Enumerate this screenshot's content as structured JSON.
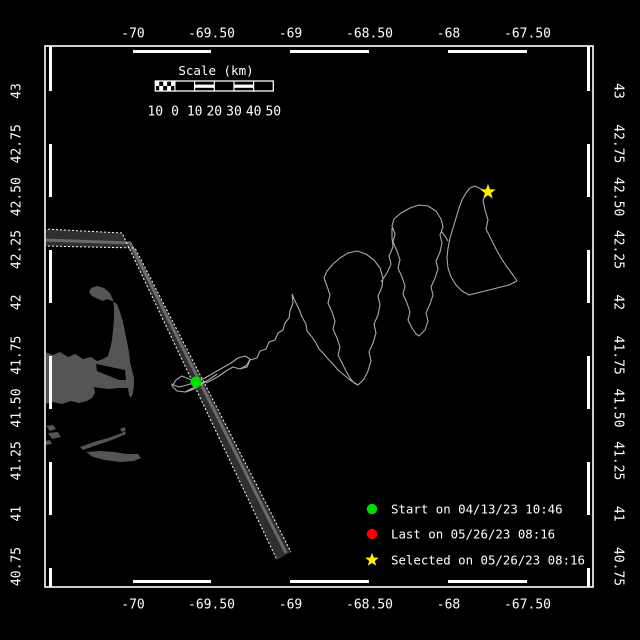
{
  "colors": {
    "background": "#000000",
    "frame": "#ffffff",
    "land": "#555555",
    "lane_band": "#2f2f2f",
    "lane_stripe": "#6a6a6a",
    "lane_edge": "#ffffff",
    "track": "#aaaaaa",
    "start_marker": "#00dd00",
    "last_marker": "#ff0000",
    "selected_marker": "#ffee00"
  },
  "axes": {
    "top": {
      "labels": [
        "-70",
        "-69.50",
        "-69",
        "-68.50",
        "-68",
        "-67.50"
      ],
      "ticks_px": [
        133,
        211.5,
        290.5,
        369.5,
        448.5,
        527.5
      ],
      "y_px": 33
    },
    "bottom": {
      "labels": [
        "-70",
        "-69.50",
        "-69",
        "-68.50",
        "-68",
        "-67.50"
      ],
      "ticks_px": [
        133,
        211.5,
        290.5,
        369.5,
        448.5,
        527.5
      ],
      "y_px": 604
    },
    "left": {
      "labels": [
        "43",
        "42.75",
        "42.50",
        "42.25",
        "42",
        "41.75",
        "41.50",
        "41.25",
        "41",
        "40.75"
      ],
      "ticks_px": [
        91,
        143.8,
        196.7,
        249.5,
        302.3,
        355.2,
        408,
        460.8,
        513.7,
        566.5
      ],
      "x_px": 16
    },
    "right": {
      "labels": [
        "43",
        "42.75",
        "42.50",
        "42.25",
        "42",
        "41.75",
        "41.50",
        "41.25",
        "41",
        "40.75"
      ],
      "ticks_px": [
        91,
        143.8,
        196.7,
        249.5,
        302.3,
        355.2,
        408,
        460.8,
        513.7,
        566.5
      ],
      "x_px": 619
    }
  },
  "scalebar": {
    "title": "Scale (km)",
    "labels": [
      "10",
      "0",
      "10",
      "20",
      "30",
      "40",
      "50"
    ],
    "label_px": [
      155.3,
      175,
      194.7,
      214.3,
      234,
      253.7,
      273.3
    ],
    "labels_y_px": 111,
    "title_x_px": 216,
    "title_y_px": 71
  },
  "legend": [
    {
      "marker": "circle",
      "color": "#00dd00",
      "icon": "start-dot-icon",
      "label": "Start on 04/13/23 10:46"
    },
    {
      "marker": "circle",
      "color": "#ff0000",
      "icon": "last-dot-icon",
      "label": "Last on 05/26/23 08:16"
    },
    {
      "marker": "star",
      "color": "#ffee00",
      "icon": "selected-star-icon",
      "label": "Selected on 05/26/23 08:16"
    }
  ],
  "legend_layout": {
    "marker_x": 372,
    "rows_y": [
      509,
      534,
      560
    ],
    "text_offset_x": 19
  },
  "map": {
    "coast_d": "M45,352 L53,355 L60,352 L68,357 L75,354 L83,359 L91,357 L97,361 L103,359 L108,356 L110,349 L112,340 L113,330 L114,319 L114,308 L113,300 L110,293 L104,288 L97,286 L91,288 L89,292 L92,296 L98,299 L103,301 L107,299 L112,301 L117,304 L120,312 L123,322 L125,332 L127,342 L129,352 L130,362 L132,370 L134,378 L134,386 L133,393 L131,398 L129,395 L128,388 L118,388 L109,389 L100,388 L94,387 L95,393 L92,398 L87,401 L79,403 L71,401 L62,404 L53,402 L45,404 Z",
    "bay_notch_d": "M96,364 L125,370 L126,380 L119,380 L97,371 Z",
    "islands_d": "M46,426 L53,425 L56,429 L50,431 Z M48,433 L58,432 L61,437 L52,439 Z M45,441 L50,440 L52,444 L46,445 Z M80,447 L94,442 L108,438 L122,433 L125,431 L126,434 L112,440 L97,445 L83,450 Z M86,452 L100,451 L114,452 L127,454 L138,454 L141,458 L134,461 L120,462 L105,460 L93,457 Z M120,429 L124,427 L126,430 L122,432 Z",
    "lane_fill_d": "M44,229 L122,233 L277,560 L291,552 L135,248 L44,246 Z",
    "lane_stripe_d": "M44,240 L130,243 L286,553",
    "lane_edge_a_d": "M44,229 L122,233 L277,560",
    "lane_edge_b_d": "M44,246 L135,248 L291,552",
    "track_d": "M196,382 L189,379 L182,376 L176,380 L172,386 L177,391 L185,392 L193,388 L199,384 L206,381 M186,392 L194,389 L202,384 L210,379 L217,374 M171,384 L179,387 L187,385 L196,382 L203,379 L210,375 L217,371 L224,367 L231,363 L238,358 L245,356 L250,359 L247,365 L240,369 L233,367 L226,371 L219,376 L212,380 L206,383 M240,369 L247,367 L250,360 L257,358 L260,351 L266,349 L269,342 L275,340 L278,333 L283,330 L285,323 L289,318 L290,311 L293,303 L292,294 L295,301 L299,309 L302,317 L306,324 L307,331 L312,337 L316,343 L319,349 L324,354 L328,359 L333,364 L338,370 L344,375 L350,380 L358,385 M358,385 L364,379 L368,371 L371,361 L369,352 L373,343 L376,333 L374,324 L378,315 L380,305 L378,296 L382,287 L383,278 L380,268 L374,260 L366,254 L357,251 L348,253 L340,258 L333,264 L327,271 L324,278 L327,286 L330,295 L328,303 L332,312 L335,321 L333,329 L337,338 L340,347 L338,355 L342,363 L346,371 L350,378 L354,383 Z M381,282 L387,273 L391,264 L389,256 L393,247 L392,238 L392,228 M419,336 L425,330 L428,321 L426,313 L430,304 L433,295 L431,287 L435,278 L438,269 L436,261 L440,252 L442,243 L440,235 L443,227 L441,219 L436,211 L428,206 L419,205 L410,208 L401,213 L394,219 L392,226 L395,234 L393,242 L397,251 L400,260 L398,268 L402,277 L405,286 L403,294 L407,303 L410,312 L408,320 L412,328 L416,334 Z M441,231 L445,236 L448,241 M488,192 L483,200 L485,210 L488,220 L486,229 L491,239 L496,249 L501,258 L507,267 L513,275 L517,281 L509,285 L501,287 L493,289 L485,291 L477,293 L469,295 L462,291 L456,285 L451,277 L448,268 L447,258 L448,248 L450,238 L453,228 L456,218 L459,208 L462,200 L466,193 L470,188 L475,186 L481,189 L488,192",
    "markers": {
      "start_transform": "translate(196,382)",
      "selected_transform": "translate(488,192)"
    }
  }
}
